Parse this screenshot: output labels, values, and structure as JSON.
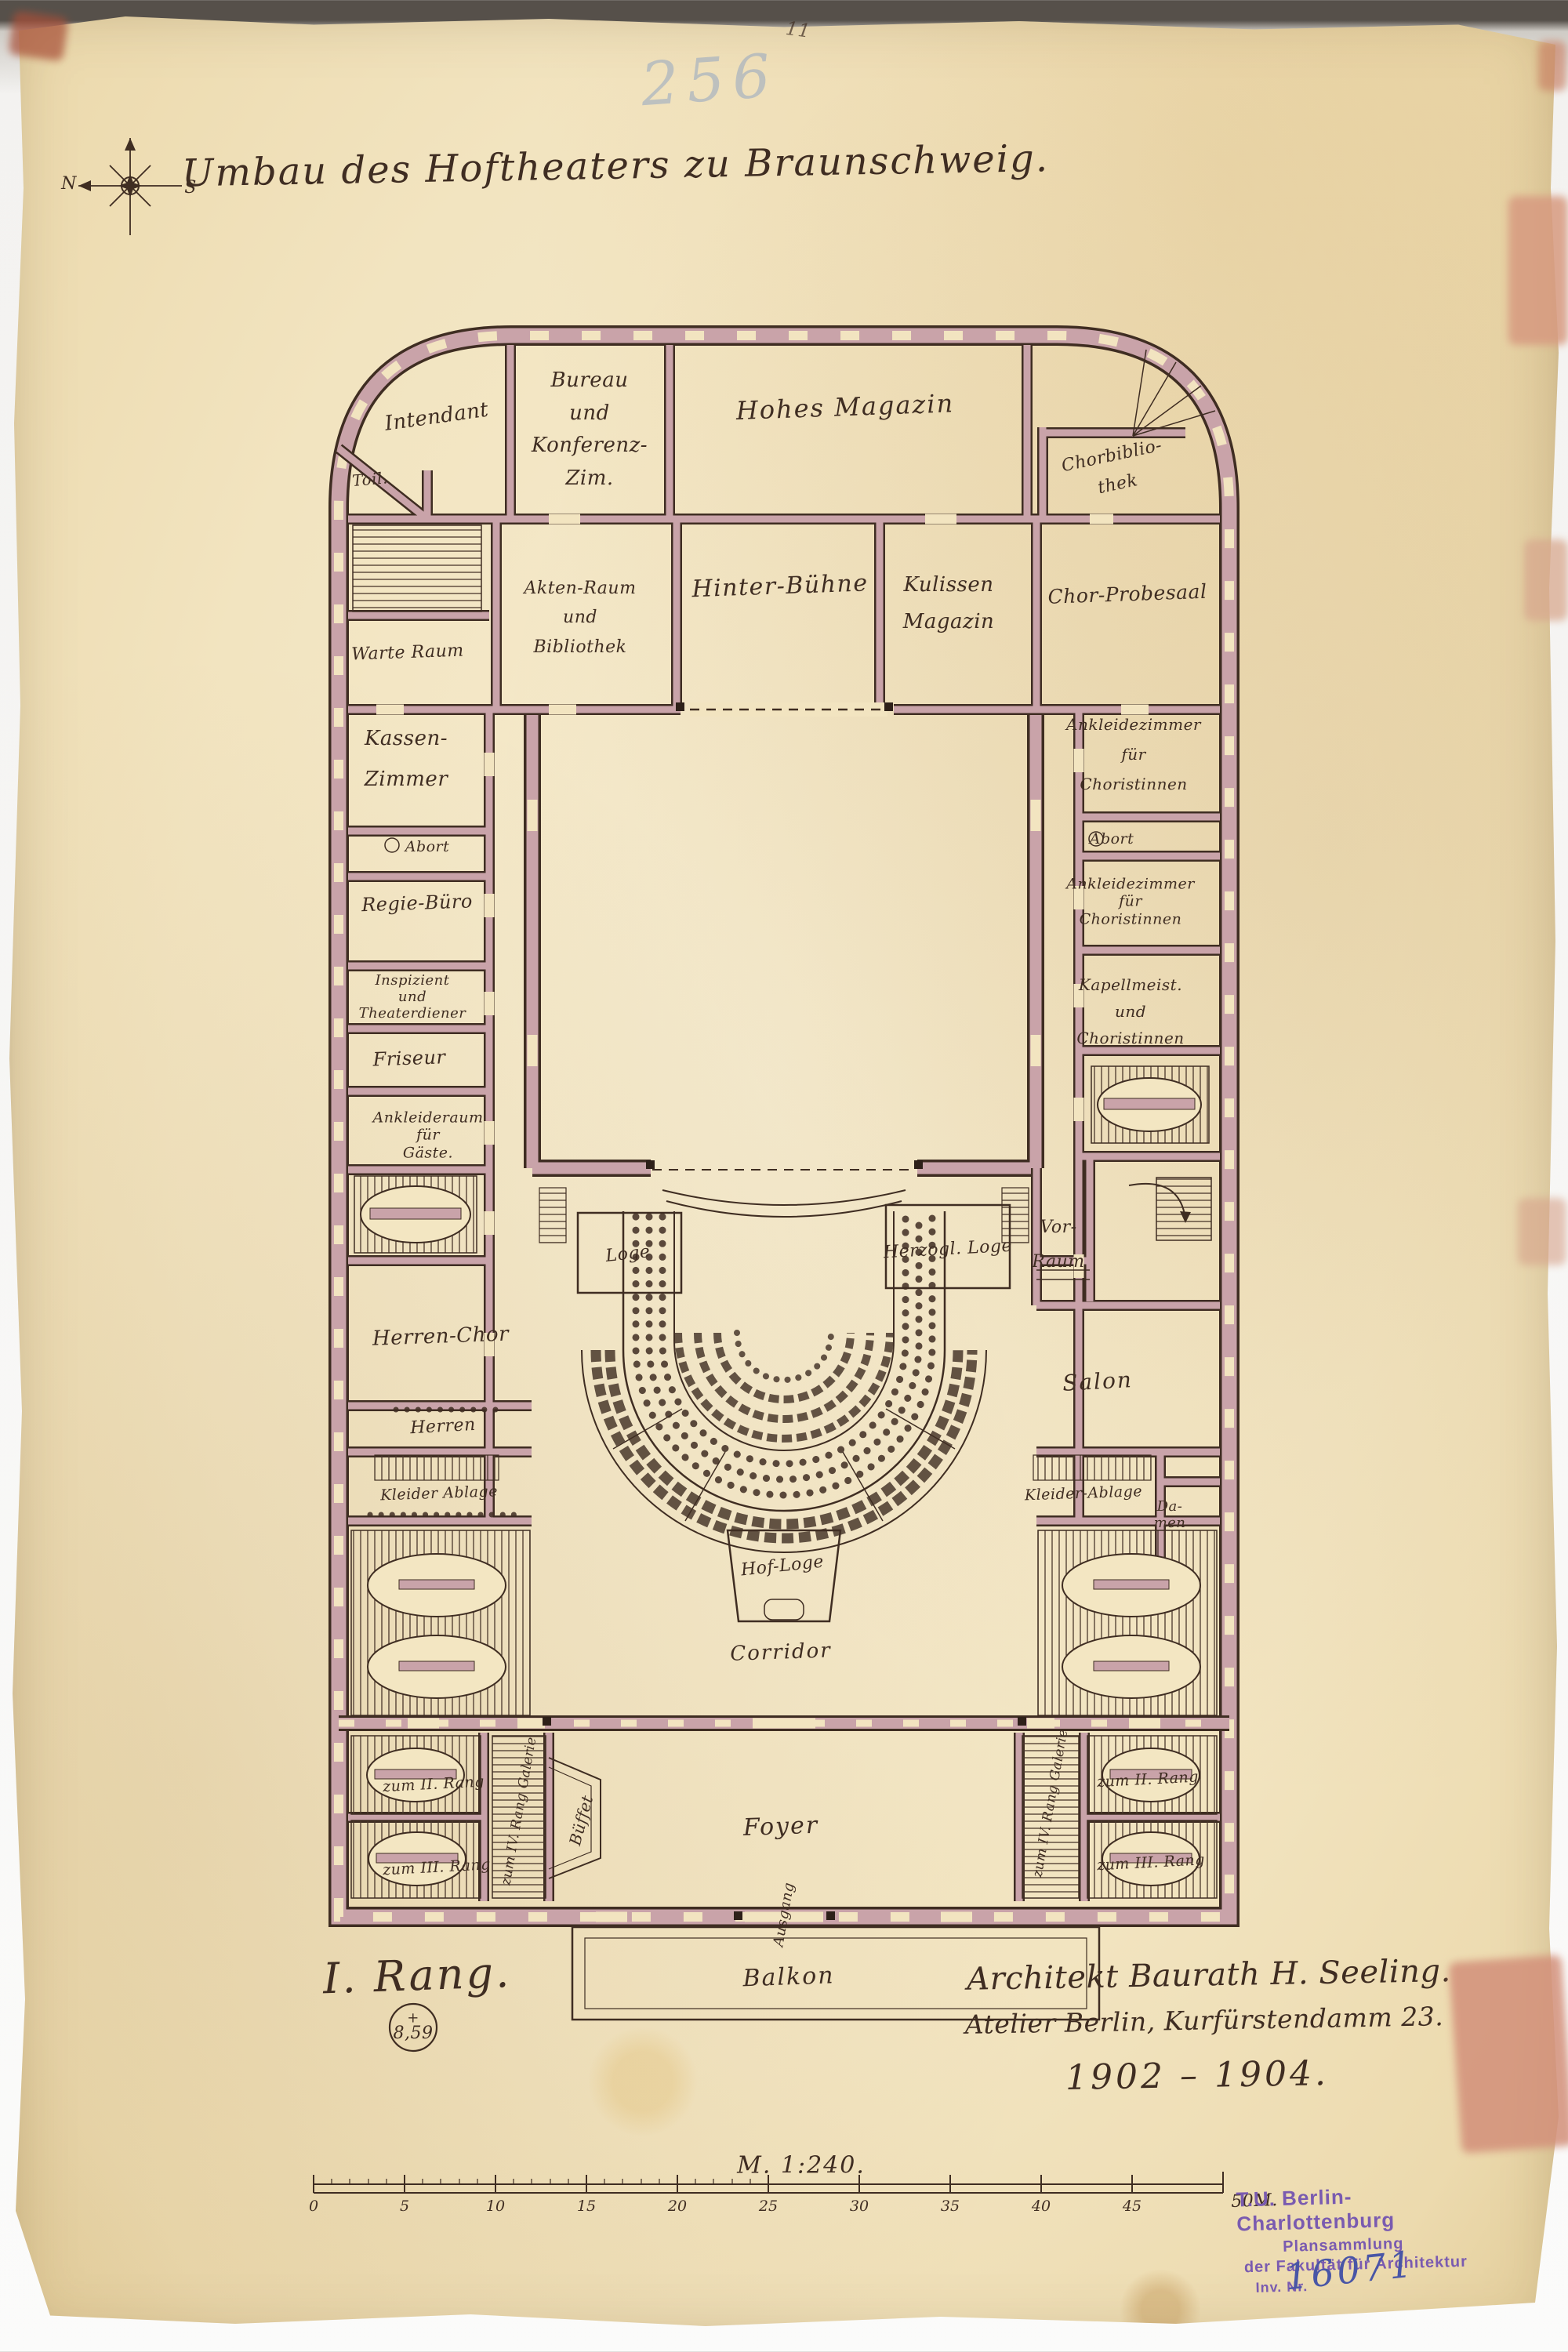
{
  "page": {
    "title": "Umbau des Hoftheaters zu Braunschweig.",
    "floor_label": "I. Rang.",
    "sheet_number": "256",
    "corner_mark": "11"
  },
  "compass": {
    "west_label": "N",
    "east_label": "S"
  },
  "rooms": {
    "intendant": "Intendant",
    "toilette": "Toil.",
    "bureau": "Bureau\nund\nKonferenz-\nZim.",
    "hohes_magazin": "Hohes Magazin",
    "chorbibliothek": "Chorbiblio-\nthek",
    "akten_raum": "Akten-Raum\nund\nBibliothek",
    "hinter_buehne": "Hinter-Bühne",
    "kulissen_magazin": "Kulissen\nMagazin",
    "chor_probesaal": "Chor-Probesaal",
    "warte_raum": "Warte Raum",
    "kassen_zimmer": "Kassen-\nZimmer",
    "abort_links": "Abort",
    "regie_buero": "Regie-Büro",
    "inspizient": "Inspizient\nund\nTheaterdiener",
    "friseur": "Friseur",
    "ankleideraum_gaeste": "Ankleideraum\nfür\nGäste.",
    "herren_chor": "Herren-Chor",
    "herren": "Herren",
    "kleider_ablage_links": "Kleider Ablage",
    "ankleide_choristinnen_oben": "Ankleidezimmer\nfür\nChoristinnen",
    "abort_rechts": "Abort",
    "ankleide_choristinnen_unten": "Ankleidezimmer\nfür\nChoristinnen",
    "kapellmeister": "Kapellmeist.\nund\nChoristinnen",
    "vor_raum": "Vor-\nRaum",
    "salon": "Salon",
    "kleider_ablage_rechts": "Kleider-Ablage",
    "damen": "Da-\nmen",
    "loge": "Loge",
    "herzogl_loge": "Herzogl. Loge",
    "hof_loge": "Hof-Loge",
    "corridor": "Corridor",
    "foyer": "Foyer",
    "bueffet": "Büffet",
    "balkon": "Balkon",
    "ausgang": "Ausgang"
  },
  "stairs": {
    "zum_ii_rang_links": "zum II. Rang",
    "zum_iii_rang_links": "zum III. Rang",
    "galerie_links": "zum IV. Rang Galerie",
    "zum_ii_rang_rechts": "zum II. Rang",
    "zum_iii_rang_rechts": "zum III. Rang",
    "galerie_rechts": "zum IV. Rang Galerie"
  },
  "annotations": {
    "architect_line1": "Architekt Baurath H. Seeling.",
    "architect_line2": "Atelier Berlin, Kurfürstendamm 23.",
    "years": "1902 – 1904.",
    "scale_text": "M. 1:240.",
    "elevation_plus": "+",
    "elevation_value": "8,59"
  },
  "scale_bar": {
    "labels": [
      "0",
      "5",
      "10",
      "15",
      "20",
      "25",
      "30",
      "35",
      "40",
      "45"
    ],
    "end_label": "50M."
  },
  "stamp": {
    "line1": "T.U. Berlin-Charlottenburg",
    "line2": "Plansammlung",
    "line3": "der Fakultät für Architektur",
    "line4": "Inv. Nr.",
    "inventory_number": "16071"
  },
  "colors": {
    "paper": "#f2e4c0",
    "ink": "#3f2d22",
    "wall": "#c9a3a9",
    "stamp_purple": "#7a5bb0",
    "blue_ink": "#4956a6",
    "pencil_blue": "#7e99c4"
  }
}
